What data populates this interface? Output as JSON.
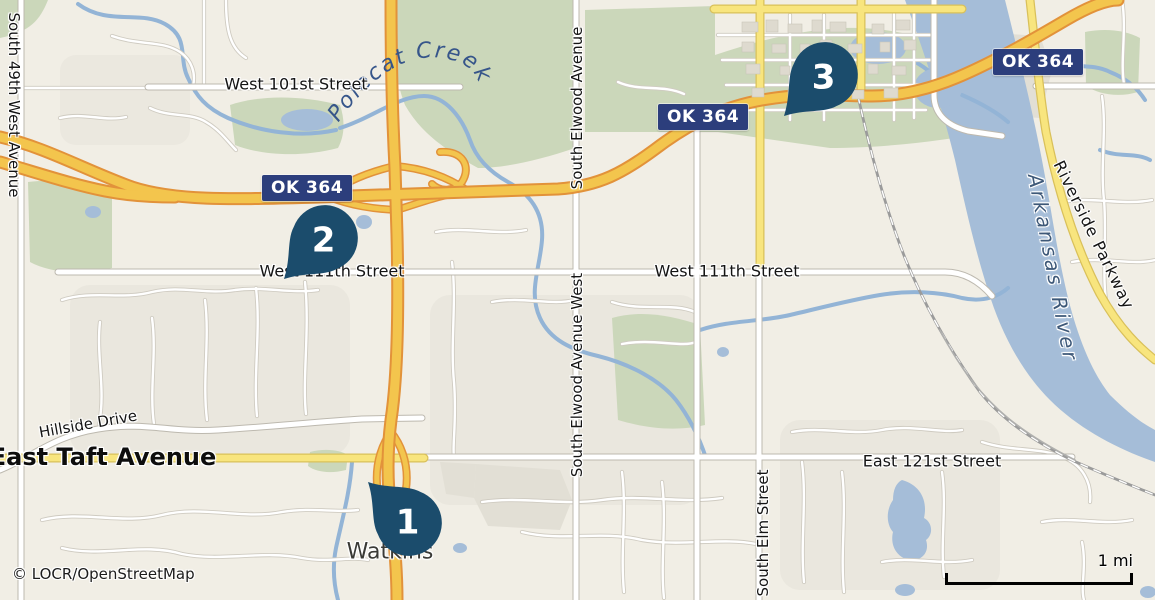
{
  "map": {
    "attribution": "© LOCR/OpenStreetMap",
    "scale": {
      "label": "1 mi"
    },
    "town_label": "Watkins",
    "water_labels": {
      "river": "Arkansas River",
      "creek": "Polecat Creek"
    },
    "route_badges": [
      {
        "id": "badge-west",
        "label": "OK 364"
      },
      {
        "id": "badge-mid",
        "label": "OK 364"
      },
      {
        "id": "badge-east",
        "label": "OK 364"
      }
    ],
    "street_labels": [
      {
        "id": "west-101st",
        "label": "West 101st Street"
      },
      {
        "id": "west-111th-left",
        "label": "West 111th Street"
      },
      {
        "id": "west-111th-right",
        "label": "West 111th Street"
      },
      {
        "id": "east-121st",
        "label": "East 121st Street"
      },
      {
        "id": "east-taft",
        "label": "East Taft Avenue"
      },
      {
        "id": "hillside",
        "label": "Hillside Drive"
      },
      {
        "id": "south-49th",
        "label": "South 49th West Avenue"
      },
      {
        "id": "south-elwood",
        "label": "South Elwood Avenue"
      },
      {
        "id": "south-elwood-west",
        "label": "South Elwood Avenue West"
      },
      {
        "id": "south-elm",
        "label": "South Elm Street"
      },
      {
        "id": "riverside-pkwy",
        "label": "Riverside Parkway"
      }
    ],
    "markers": [
      {
        "number": "1",
        "x": 368,
        "y": 482,
        "rotation": 135
      },
      {
        "number": "2",
        "x": 284,
        "y": 279,
        "rotation": 45
      },
      {
        "number": "3",
        "x": 784,
        "y": 116,
        "rotation": 45
      }
    ],
    "colors": {
      "marker": "#1b4c6c",
      "badge_bg": "#2c3e7c",
      "water": "#a5bdd8",
      "green": "#cbd7ba",
      "highway_fill": "#f3c54d",
      "highway_casing": "#e2923a",
      "yellow_road": "#f8e57e",
      "land": "#f1eee5"
    }
  }
}
